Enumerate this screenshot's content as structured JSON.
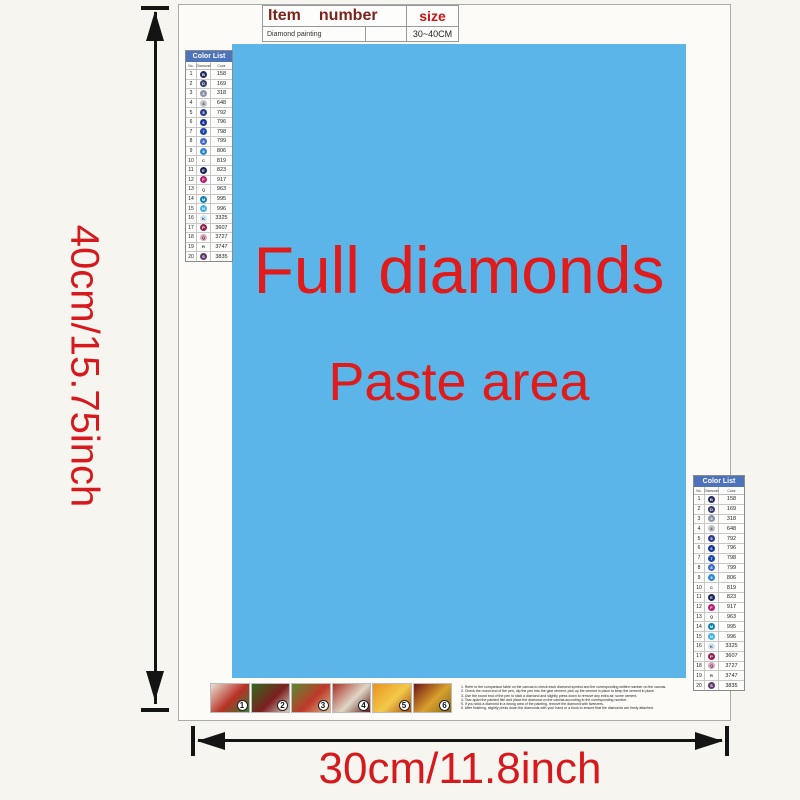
{
  "top_table": {
    "item_label": "Item",
    "number_label": "number",
    "size_label": "size",
    "item_value": "Diamond painting",
    "size_value": "30~40CM",
    "header_color": "#7c241c",
    "size_color": "#cc1414"
  },
  "dimensions": {
    "height_label": "40cm/15.75inch",
    "width_label": "30cm/11.8inch",
    "text_color": "#d6191c"
  },
  "paste_area": {
    "line1": "Full diamonds",
    "line2": "Paste area",
    "bg_color": "#5bb5e8",
    "text_color": "#e01b1b"
  },
  "color_list": {
    "title": "Color List",
    "title_bg": "#4d74ba",
    "columns": [
      "No.",
      "Diamond",
      "Color"
    ],
    "rows": [
      {
        "no": "1",
        "glyph": "B",
        "circle": "#1f2960",
        "glyph_color": "#ffffff",
        "code": "158"
      },
      {
        "no": "2",
        "glyph": "D",
        "circle": "#33406e",
        "glyph_color": "#ffffff",
        "code": "169"
      },
      {
        "no": "3",
        "glyph": "3",
        "circle": "#8a93a6",
        "glyph_color": "#ffffff",
        "code": "318"
      },
      {
        "no": "4",
        "glyph": "4",
        "circle": "#c2c6cc",
        "glyph_color": "#333333",
        "code": "648"
      },
      {
        "no": "5",
        "glyph": "5",
        "circle": "#2b3a8f",
        "glyph_color": "#ffffff",
        "code": "792"
      },
      {
        "no": "6",
        "glyph": "6",
        "circle": "#16339c",
        "glyph_color": "#ffffff",
        "code": "796"
      },
      {
        "no": "7",
        "glyph": "7",
        "circle": "#1d47ab",
        "glyph_color": "#ffffff",
        "code": "798"
      },
      {
        "no": "8",
        "glyph": "8",
        "circle": "#3d6bcc",
        "glyph_color": "#ffffff",
        "code": "799"
      },
      {
        "no": "9",
        "glyph": "9",
        "circle": "#2e86cc",
        "glyph_color": "#ffffff",
        "code": "806"
      },
      {
        "no": "10",
        "glyph": "C",
        "circle": "",
        "glyph_color": "#333333",
        "code": "819"
      },
      {
        "no": "11",
        "glyph": "E",
        "circle": "#17255c",
        "glyph_color": "#ffffff",
        "code": "823"
      },
      {
        "no": "12",
        "glyph": "F",
        "circle": "#b5206e",
        "glyph_color": "#ffffff",
        "code": "917"
      },
      {
        "no": "13",
        "glyph": "Q",
        "circle": "",
        "glyph_color": "#333333",
        "code": "963"
      },
      {
        "no": "14",
        "glyph": "M",
        "circle": "#0b7fae",
        "glyph_color": "#ffffff",
        "code": "995"
      },
      {
        "no": "15",
        "glyph": "N",
        "circle": "#3fb1e3",
        "glyph_color": "#ffffff",
        "code": "996"
      },
      {
        "no": "16",
        "glyph": "K",
        "circle": "#cfe3f2",
        "glyph_color": "#444444",
        "code": "3325"
      },
      {
        "no": "17",
        "glyph": "P",
        "circle": "#8f2353",
        "glyph_color": "#ffffff",
        "code": "3607"
      },
      {
        "no": "18",
        "glyph": "Q",
        "circle": "#d9a8bf",
        "glyph_color": "#5a2040",
        "code": "3727"
      },
      {
        "no": "19",
        "glyph": "R",
        "circle": "",
        "glyph_color": "#333333",
        "code": "3747"
      },
      {
        "no": "20",
        "glyph": "S",
        "circle": "#5e3a6e",
        "glyph_color": "#ffffff",
        "code": "3835"
      }
    ]
  },
  "steps": [
    {
      "num": "1",
      "colors": [
        "#e9e1d5",
        "#b83226",
        "#3a7a34"
      ]
    },
    {
      "num": "2",
      "colors": [
        "#33691e",
        "#7b1f1f",
        "#d7cfc0"
      ]
    },
    {
      "num": "3",
      "colors": [
        "#5a8a30",
        "#c0392b",
        "#d9b98a"
      ]
    },
    {
      "num": "4",
      "colors": [
        "#a93226",
        "#e0d6c6",
        "#5c1818"
      ]
    },
    {
      "num": "5",
      "colors": [
        "#e8941e",
        "#f3c94a",
        "#a84e10"
      ]
    },
    {
      "num": "6",
      "colors": [
        "#6e1616",
        "#d9a02c",
        "#8a6a1e"
      ]
    }
  ],
  "instructions": [
    "1. Refer to the comparison table on the canvas to check each diamond symbol and the corresponding written number on the canvas.",
    "2. Check the round end of the pen, dip the pen into the glue cement, pick up the cement in place to keep the cement in place.",
    "3. Use the round end of the pen to stick a diamond and slightly press down to remove any extra air, some cement.",
    "4. Tear apart the painted film and place the diamond on the canvas according to the corresponding number.",
    "5. If you stick a diamond in a wrong area of the painting, remove the diamond with tweezers.",
    "6. After finishing, slightly press down the diamonds with your hand or a book to ensure that the diamonds are firmly attached."
  ]
}
